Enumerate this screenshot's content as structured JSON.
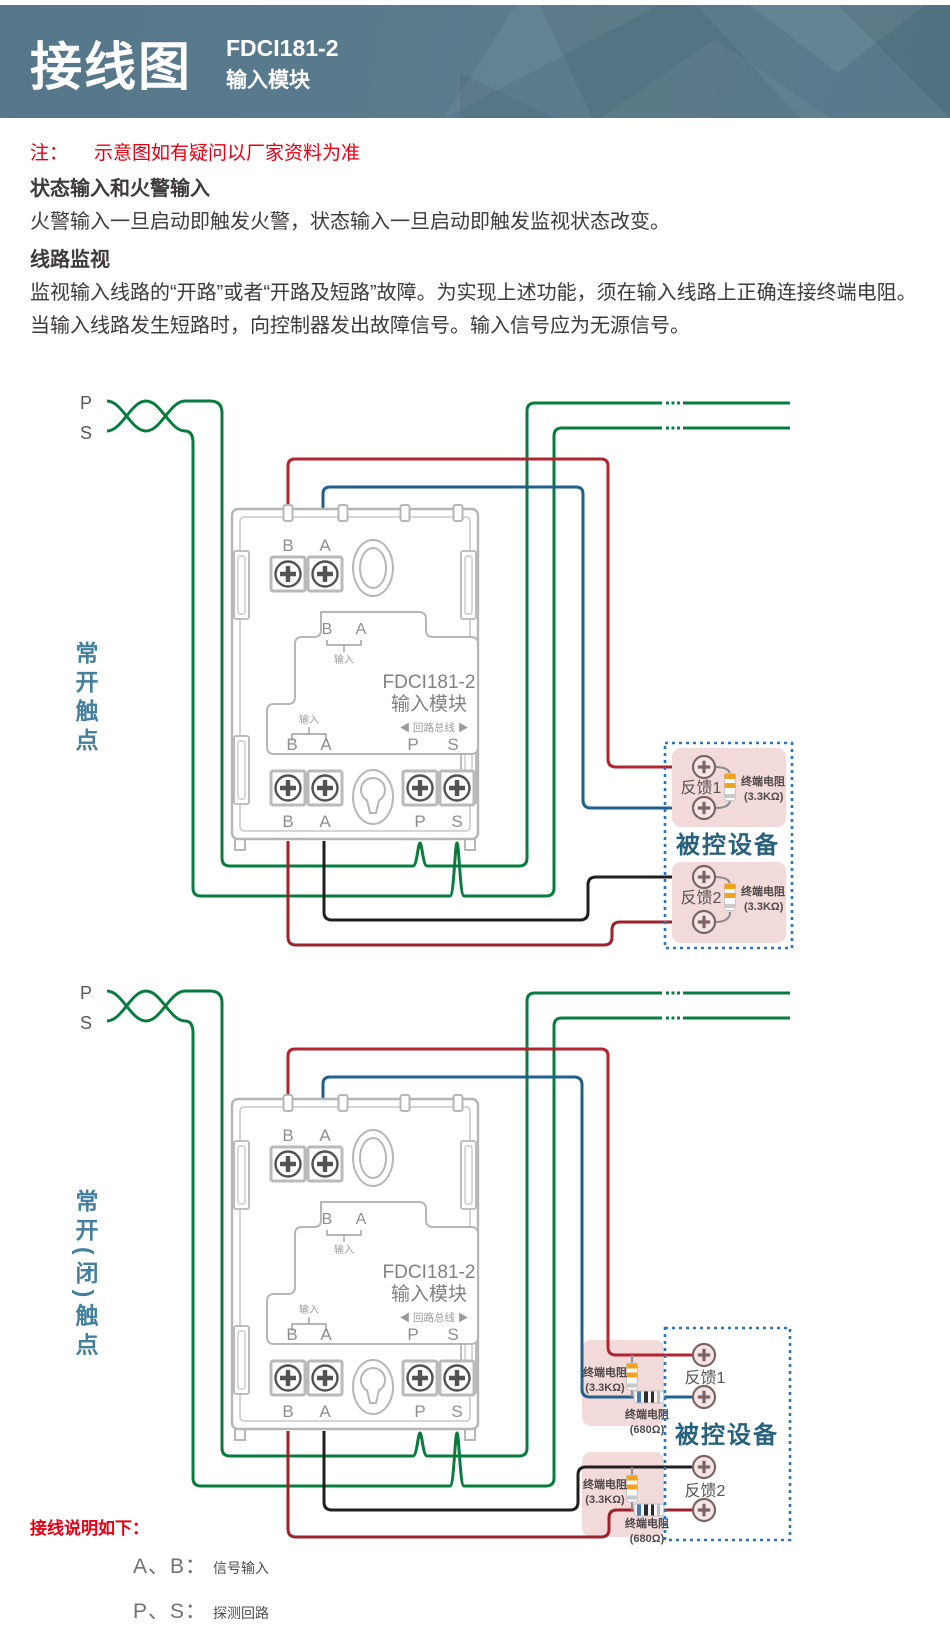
{
  "header": {
    "title": "接线图",
    "model": "FDCI181-2",
    "subtitle": "输入模块"
  },
  "intro": {
    "note_label": "注：",
    "note_text": "示意图如有疑问以厂家资料为准",
    "heading1": "状态输入和火警输入",
    "para1": "火警输入一旦启动即触发火警，状态输入一旦启动即触发监视状态改变。",
    "heading2": "线路监视",
    "para2": "监视输入线路的“开路”或者“开路及短路”故障。为实现上述功能，须在输入线路上正确连接终端电阻。当输入线路发生短路时，向控制器发出故障信号。输入信号应为无源信号。"
  },
  "module": {
    "b": "B",
    "a": "A",
    "p": "P",
    "s": "S",
    "model_line1": "FDCI181-2",
    "model_line2": "输入模块",
    "input_label": "输入",
    "bus_label": "◀ 回路总线 ▶"
  },
  "loop": {
    "p": "P",
    "s": "S"
  },
  "diagram1": {
    "side_label": "常开触点",
    "device_title": "被控设备",
    "fb1": "反馈1",
    "fb2": "反馈2"
  },
  "diagram2": {
    "side_label": "常开(闭)触点",
    "device_title": "被控设备",
    "fb1": "反馈1",
    "fb2": "反馈2"
  },
  "resistor": {
    "label": "终端电阻",
    "value_33k": "(3.3KΩ)",
    "value_680": "(680Ω)"
  },
  "legend": {
    "title": "接线说明如下：",
    "item1_term": "A、B：",
    "item1_desc": "信号输入",
    "item2_term": "P、S：",
    "item2_desc": "探测回路"
  },
  "colors": {
    "wire_green": "#077c3f",
    "wire_red": "#b02530",
    "wire_maroon": "#9e222b",
    "wire_blue": "#20608f",
    "wire_black": "#221e1f",
    "box_dash_blue": "#2d74b8",
    "pink_fill": "#f2d9da",
    "header_bg": "#5b7c8d",
    "accent_red": "#e60012",
    "label_teal": "#44809e",
    "device_text": "#28617e",
    "module_gray": "#b4b6b8"
  }
}
